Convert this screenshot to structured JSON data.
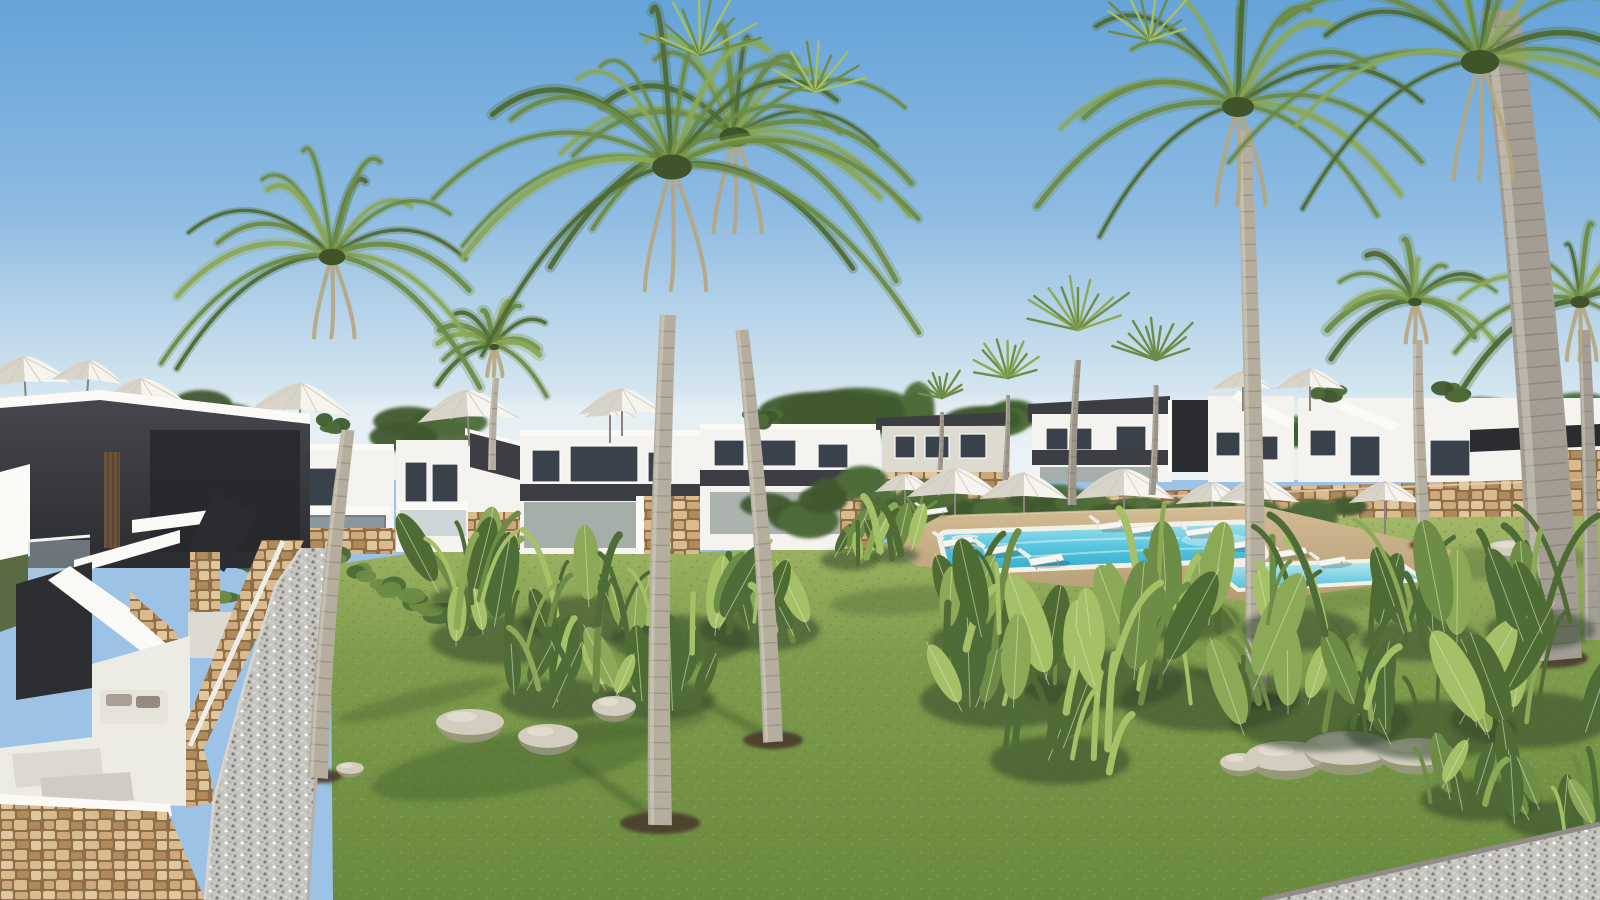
{
  "scene": {
    "type": "architectural-3d-render",
    "setting": "modern Mediterranean residential resort complex",
    "time_of_day": "sunny daytime, clear blue sky",
    "description": "Photorealistic render of a new-build apartment development: white and charcoal two-storey homes with glass balustrades and natural stone walls surround a large landscaped lawn. Tall palm trees stand in the grass, a turquoise communal swimming pool with a separate children's pool is lined with white sun loungers and parasols, and gravel walkways and tropical plant beds frame the foreground."
  },
  "palette": {
    "sky_top": "#66a3d8",
    "sky_mid": "#9cc3e6",
    "sky_horizon": "#e9f1f6",
    "lawn_light": "#a9bd6d",
    "lawn_mid": "#7e9c4c",
    "lawn_dark": "#69893e",
    "lawn_shadow": "#3a532b",
    "building_white": "#f4f3ef",
    "building_bright": "#fbfaf7",
    "building_shade": "#dddad2",
    "building_deep": "#c2bfb7",
    "charcoal": "#3c3e43",
    "charcoal_dark": "#2b2c30",
    "charcoal_light": "#55575d",
    "glass_dark": "#39424a",
    "glass_light": "#8ba0ac",
    "stone_mortar": "#8f6f4a",
    "deck_sand": "#c9b189",
    "deck_sand_dark": "#b29a70",
    "pool_light": "#a8e4ef",
    "pool_mid": "#55c4dd",
    "pool_deep": "#2fa8cc",
    "coping_white": "#f3f0e6",
    "gravel_light": "#cac9c3",
    "gravel_dark": "#8f8d85",
    "parasol_white": "#f6f4ee",
    "parasol_shade": "#d9d4c9",
    "trunk_light": "#b5ae9f",
    "trunk_gray": "#a39d94",
    "trunk_ring": "#7c766a",
    "frond_dark": "#4e6b33",
    "frond_mid": "#6d8c45",
    "frond_light": "#8ba957",
    "frond_lime": "#a4c167",
    "frond_dry": "#b6a67d",
    "mulch": "#4c3b2d",
    "boulder_light": "#d3cdbf",
    "boulder_shade": "#a29b8d",
    "timber": "#6b523c",
    "floor_white": "#ecebe4",
    "hedge_dark": "#3f5a2e",
    "hedge_mid": "#4e6c38"
  },
  "inventory": {
    "palm_trees": 12,
    "parasols": 16,
    "sun_loungers": 14,
    "swimming_pools": 2,
    "building_blocks": 8,
    "plant_beds": 3,
    "boulders": 9,
    "topiary_shrubs": 4,
    "outdoor_sofas": 1,
    "gravel_paths": 2,
    "terraces": 3
  }
}
